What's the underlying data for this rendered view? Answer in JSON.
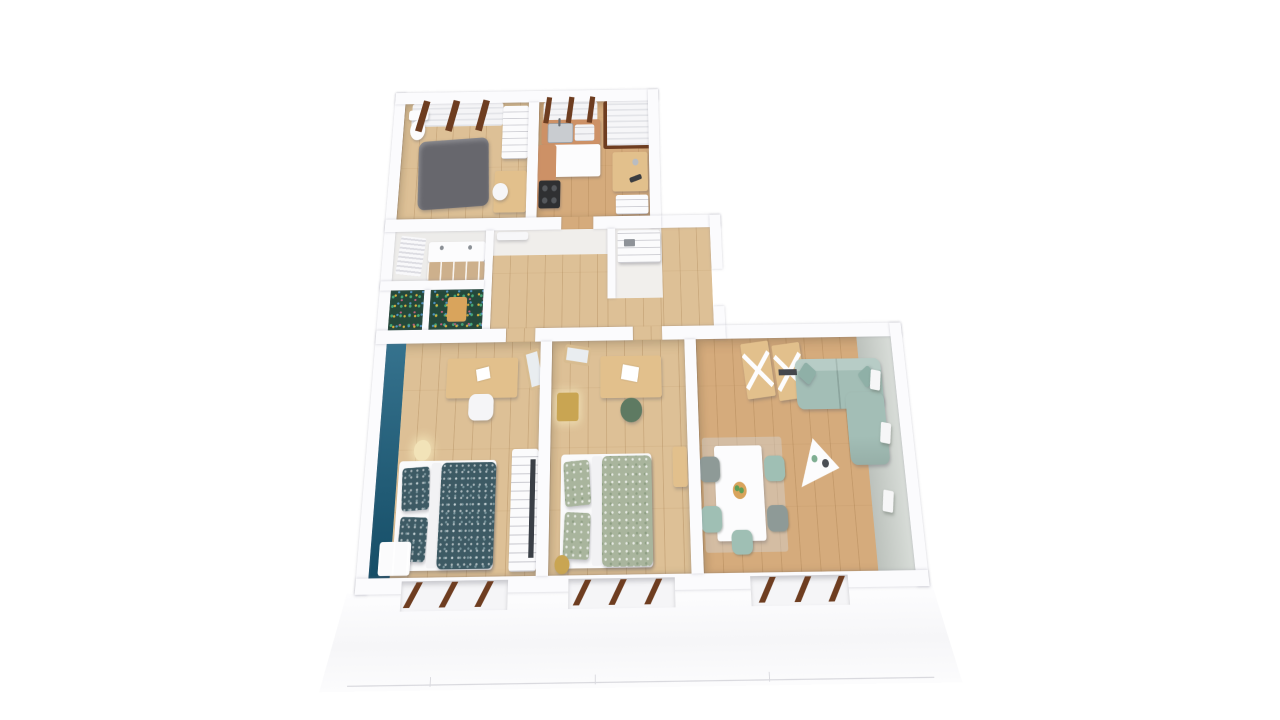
{
  "meta": {
    "label": "3D rendered floor plan of a 4-room apartment, dollhouse top view on white background",
    "view": "perspective top-down cutaway",
    "visible_text": "none"
  },
  "palette": {
    "background": "#ffffff",
    "wall": "#fbfbfd",
    "floor_light": "#ddc096",
    "floor_warm": "#d5ab7c",
    "tile_white": "#edecea",
    "hall_white": "#f0eeeb",
    "closet_white": "#f1efec",
    "teal_wall": "#1a5f7e",
    "duvet_teal": "#3d5a64",
    "duvet_sage": "#a9b59d",
    "sofa_sage": "#a3beb6",
    "wallface_sage": "#ccd2cc",
    "window_frame_brown": "#6e3d20",
    "desk_wood": "#e2c08c",
    "counter_wood": "#cd9166",
    "gold": "#c9a552",
    "mat_gray": "#67676d",
    "jungle_green": "#24483a",
    "stove_dark": "#2f3032",
    "chair_sage": "#9fbfb4",
    "chair_gray": "#8e9a97",
    "white_furniture": "#fcfcfd",
    "lamp_glow": "#f2e3b8",
    "rug_gray": "rgba(210,210,210,0.45)",
    "mirror_glass": "#e9edf0",
    "sink_steel": "#c9ccd0",
    "bowl_wood": "#d9a45c",
    "plant_green": "#5f9e57"
  },
  "rooms": [
    {
      "id": "utility-room",
      "label": "utility room / small bathroom",
      "furniture": [
        "toilet",
        "gray floor mattress",
        "wardrobe shelves",
        "small wood desk",
        "white chair",
        "window with brown frames"
      ]
    },
    {
      "id": "kitchen",
      "label": "kitchen",
      "furniture": [
        "sink counter",
        "dish rack",
        "white island",
        "wood counter",
        "dark cooktop",
        "wood desk",
        "white shelf",
        "window",
        "balcony door with brown frame"
      ]
    },
    {
      "id": "bathroom",
      "label": "bathroom",
      "furniture": [
        "double vanity with wood drawers",
        "towel radiator"
      ]
    },
    {
      "id": "wc",
      "label": "WC with jungle wallpaper",
      "furniture": [
        "wood step",
        "jungle patterned floor"
      ]
    },
    {
      "id": "hallway",
      "label": "hallway",
      "furniture": [
        "white double door"
      ]
    },
    {
      "id": "closet",
      "label": "storage closet",
      "furniture": [
        "white cubby shelf"
      ]
    },
    {
      "id": "corridor",
      "label": "corridor to living room",
      "furniture": []
    },
    {
      "id": "bedroom-1",
      "label": "bedroom with teal accent wall",
      "furniture": [
        "double bed with teal patterned duvet",
        "two teal pillows",
        "white nightstand",
        "sphere lamp",
        "wood desk",
        "white chair",
        "mirror",
        "white wardrobe"
      ]
    },
    {
      "id": "bedroom-2",
      "label": "bedroom with sage bedding",
      "furniture": [
        "double bed with sage patterned duvet",
        "two sage pillows",
        "gold nightstand with lamp",
        "wood desk",
        "green chair",
        "mirror",
        "gold stool",
        "wood console"
      ]
    },
    {
      "id": "living-room",
      "label": "living room / dining",
      "furniture": [
        "sage L-shaped sofa",
        "two ladder X-frame shelves",
        "triangular white coffee table",
        "white dining table",
        "sage and gray chairs",
        "fruit bowl",
        "three wall sconces",
        "light rug"
      ]
    }
  ],
  "exterior": {
    "windows_bottom_wall": 3,
    "facade": "white band with faint panel seams",
    "frame_color_name": "brown"
  }
}
